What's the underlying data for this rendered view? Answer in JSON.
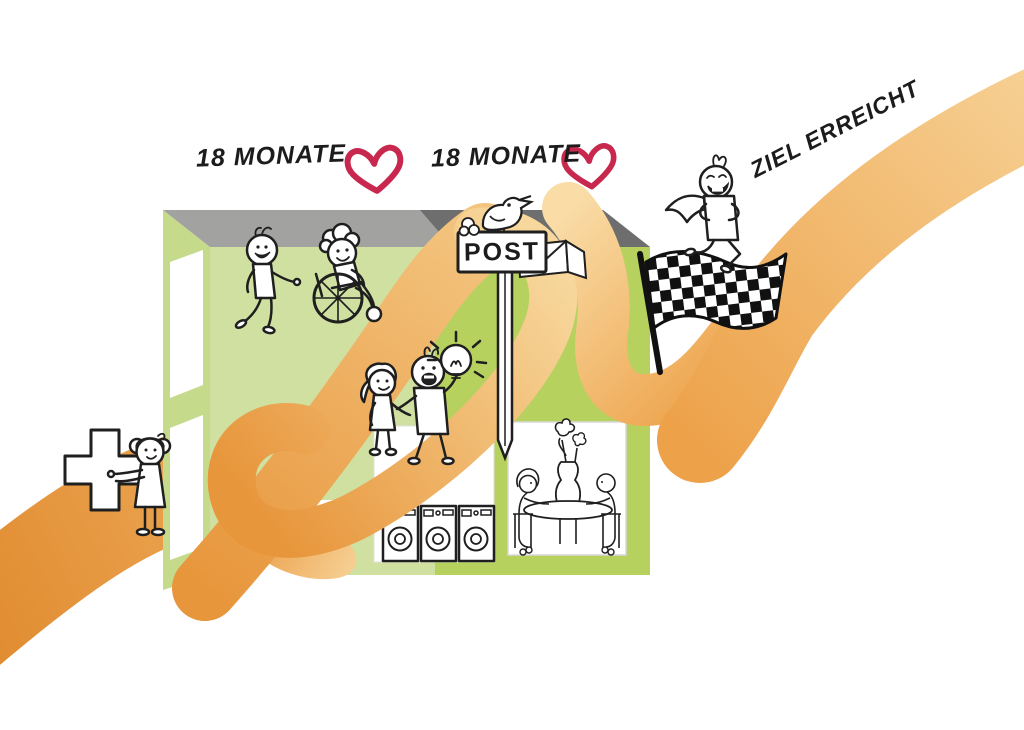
{
  "labels": {
    "milestone1": "18 MONATE",
    "milestone2": "18 MONATE",
    "goal": "ZIEL ERREICHT",
    "post_sign": "POST"
  },
  "colors": {
    "background": "#ffffff",
    "ribbon_dark": "#e08a2e",
    "ribbon_main": "#e8963c",
    "ribbon_mid": "#efae5e",
    "ribbon_light": "#f6cf92",
    "ribbon_pale": "#f9dca6",
    "facade_left": "#cfe0a0",
    "facade_right": "#b6d15e",
    "side_face": "#c6da8c",
    "roof_light": "#a2a2a0",
    "roof_dark": "#6e6e6e",
    "heart": "#c8274e",
    "outline": "#1f1f1f"
  },
  "scene": {
    "elements": [
      {
        "id": "orange-ribbon-path",
        "desc": "winding orange ribbon journey from lower left to upper right"
      },
      {
        "id": "green-building",
        "desc": "isometric green building with gray roof, windows and open door"
      },
      {
        "id": "nurse-with-medical-cross",
        "desc": "woman holding a large medical cross at the entrance"
      },
      {
        "id": "person-walking",
        "desc": "smiling person walking beside wheelchair user"
      },
      {
        "id": "person-in-wheelchair",
        "desc": "curly haired person in a wheelchair"
      },
      {
        "id": "couple-with-idea-lightbulb",
        "desc": "woman and man, man pointing at a shining lightbulb"
      },
      {
        "id": "post-mailbox-with-bird",
        "desc": "POST sign on a post with a bird and an envelope"
      },
      {
        "id": "laundry-window",
        "desc": "window with three washing machines"
      },
      {
        "id": "dining-window",
        "desc": "window with two people at a table with flower vase"
      },
      {
        "id": "checkered-flag",
        "desc": "waving black and white checkered finish flag"
      },
      {
        "id": "runner-with-cape",
        "desc": "cheering hero figure with cape running up the ribbon"
      },
      {
        "id": "heart-icon",
        "desc": "two outlined red hearts next to the 18 MONATE labels"
      }
    ]
  }
}
